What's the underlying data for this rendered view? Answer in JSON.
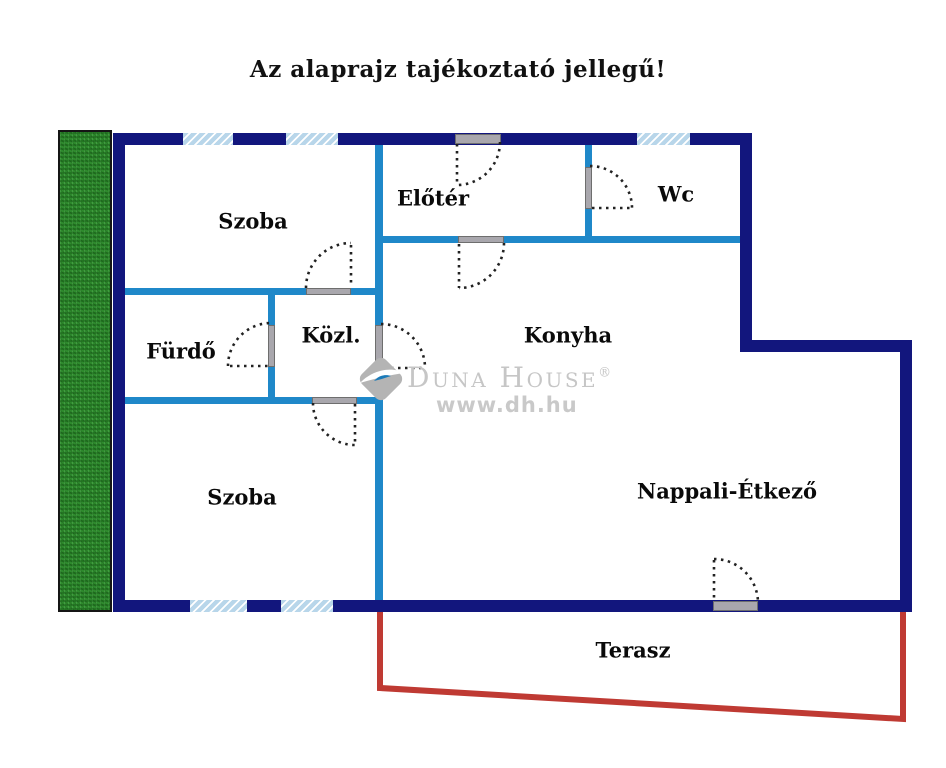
{
  "title": "Az alaprajz tajékoztató jellegű!",
  "rooms": {
    "szoba_top": {
      "label": "Szoba"
    },
    "eloter": {
      "label": "Előtér"
    },
    "wc": {
      "label": "Wc"
    },
    "furdo": {
      "label": "Fürdő"
    },
    "kozl": {
      "label": "Közl."
    },
    "konyha": {
      "label": "Konyha"
    },
    "szoba_bottom": {
      "label": "Szoba"
    },
    "nappali": {
      "label": "Nappali-Étkező"
    },
    "terasz": {
      "label": "Terasz"
    }
  },
  "watermark": {
    "brand": "Duna House",
    "registered": "®",
    "url": "www.dh.hu"
  },
  "colors": {
    "exterior_wall": "#12167d",
    "interior_wall": "#1f88c9",
    "window_fill": "#b8d6ea",
    "terrace_line": "#bf3a33",
    "garden_green": "#2e8b2d",
    "door_threshold_gray": "#a9a7ad",
    "watermark_gray": "#c6c6c6",
    "label_text": "#0a0a0a"
  }
}
